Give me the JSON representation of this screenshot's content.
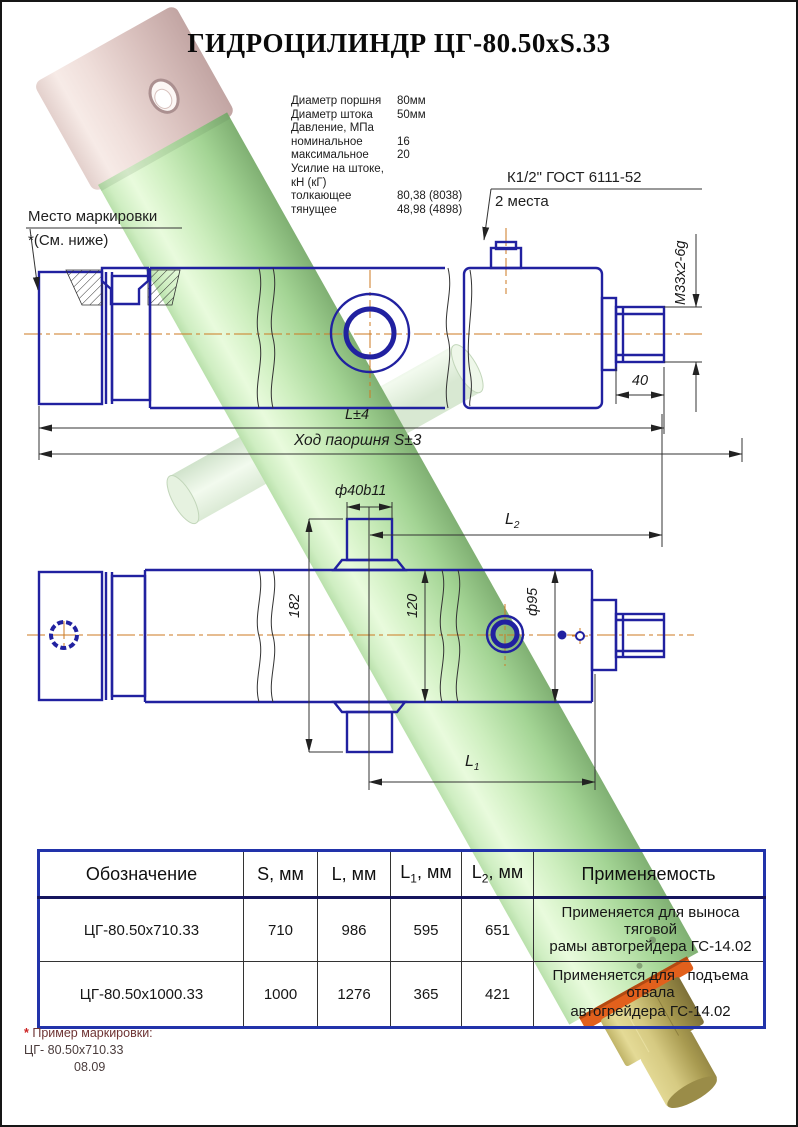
{
  "title": "ГИДРОЦИЛИНДР ЦГ-80.50xS.33",
  "specs": {
    "rows": [
      {
        "label": "Диаметр поршня",
        "value": "80мм"
      },
      {
        "label": "Диаметр штока",
        "value": "50мм"
      },
      {
        "label": "Давление, МПа",
        "value": ""
      },
      {
        "label": "номинальное",
        "value": "16"
      },
      {
        "label": "максимальное",
        "value": "20"
      },
      {
        "label": "Усилие на штоке, кН (кГ)",
        "value": ""
      },
      {
        "label": "толкающее",
        "value": "80,38 (8038)"
      },
      {
        "label": "тянущее",
        "value": "48,98 (4898)"
      }
    ]
  },
  "callouts": {
    "port": {
      "line1": "К1/2\" ГОСТ 6111-52",
      "line2": "2 места"
    },
    "marking": {
      "line1": "Место маркировки",
      "line2": "*(См. ниже)"
    }
  },
  "dims": {
    "thread": "M33x2-6g",
    "rod_length": "40",
    "overall_length": "L±4",
    "stroke": "Ход паоршня S±3",
    "pin_dia": "ф40b11",
    "l1": {
      "main": "L",
      "sub": "1"
    },
    "l2": {
      "main": "L",
      "sub": "2"
    },
    "body_width": "182",
    "port_span": "120",
    "outer_dia": "ф95"
  },
  "table": {
    "headers": {
      "designation": "Обозначение",
      "s": "S, мм",
      "l": "L, мм",
      "l1_main": "L",
      "l1_sub": "1",
      "l1_rest": ", мм",
      "l2_main": "L",
      "l2_sub": "2",
      "l2_rest": ", мм",
      "application": "Применяемость"
    },
    "rows": [
      {
        "designation": "ЦГ-80.50х710.33",
        "s": "710",
        "l": "986",
        "l1": "595",
        "l2": "651",
        "app_line1": "Применяется для выноса тяговой",
        "app_line2": "рамы автогрейдера ГС-14.02"
      },
      {
        "designation": "ЦГ-80.50х1000.33",
        "s": "1000",
        "l": "1276",
        "l1": "365",
        "l2": "421",
        "app_line1": "Применяется для   подъема отвала",
        "app_line2": "автогрейдера ГС-14.02"
      }
    ]
  },
  "footnote": {
    "marker": "*",
    "line1": " Пример маркировки:",
    "line2": "ЦГ- 80.50х710.33",
    "line3": "08.09"
  },
  "colors": {
    "blueprint_line": "#2121a0",
    "centerline": "#cc7a22",
    "cylinder_green": "#b9e7ae",
    "cap_pink": "#e7d5d5",
    "rod_tan": "#cdc27c",
    "ring_orange": "#e2601c",
    "table_border": "#2233aa",
    "footnote_accent": "#cc2222"
  }
}
